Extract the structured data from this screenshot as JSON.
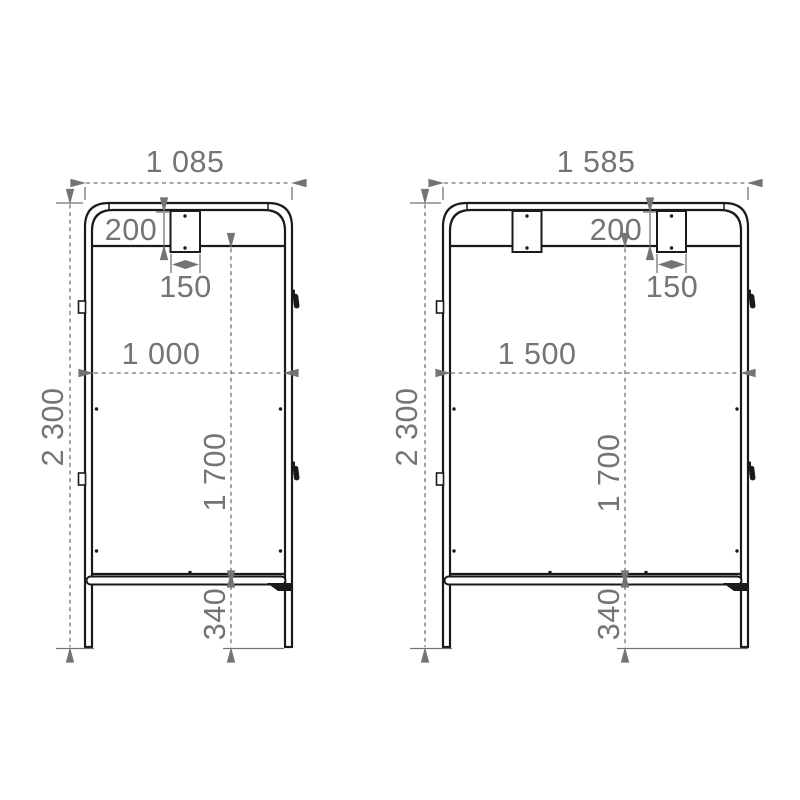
{
  "colors": {
    "background": "#ffffff",
    "frame_line": "#1a1a1a",
    "dimension": "#747474"
  },
  "drawings": [
    {
      "name": "frame-variant-1085",
      "dims": {
        "total_width": "1 085",
        "total_height": "2 300",
        "rail_height": "200",
        "bracket_width": "150",
        "inner_width": "1 000",
        "panel_height": "1 700",
        "leg_height": "340"
      }
    },
    {
      "name": "frame-variant-1585",
      "dims": {
        "total_width": "1 585",
        "total_height": "2 300",
        "rail_height": "200",
        "bracket_width": "150",
        "inner_width": "1 500",
        "panel_height": "1 700",
        "leg_height": "340"
      }
    }
  ]
}
